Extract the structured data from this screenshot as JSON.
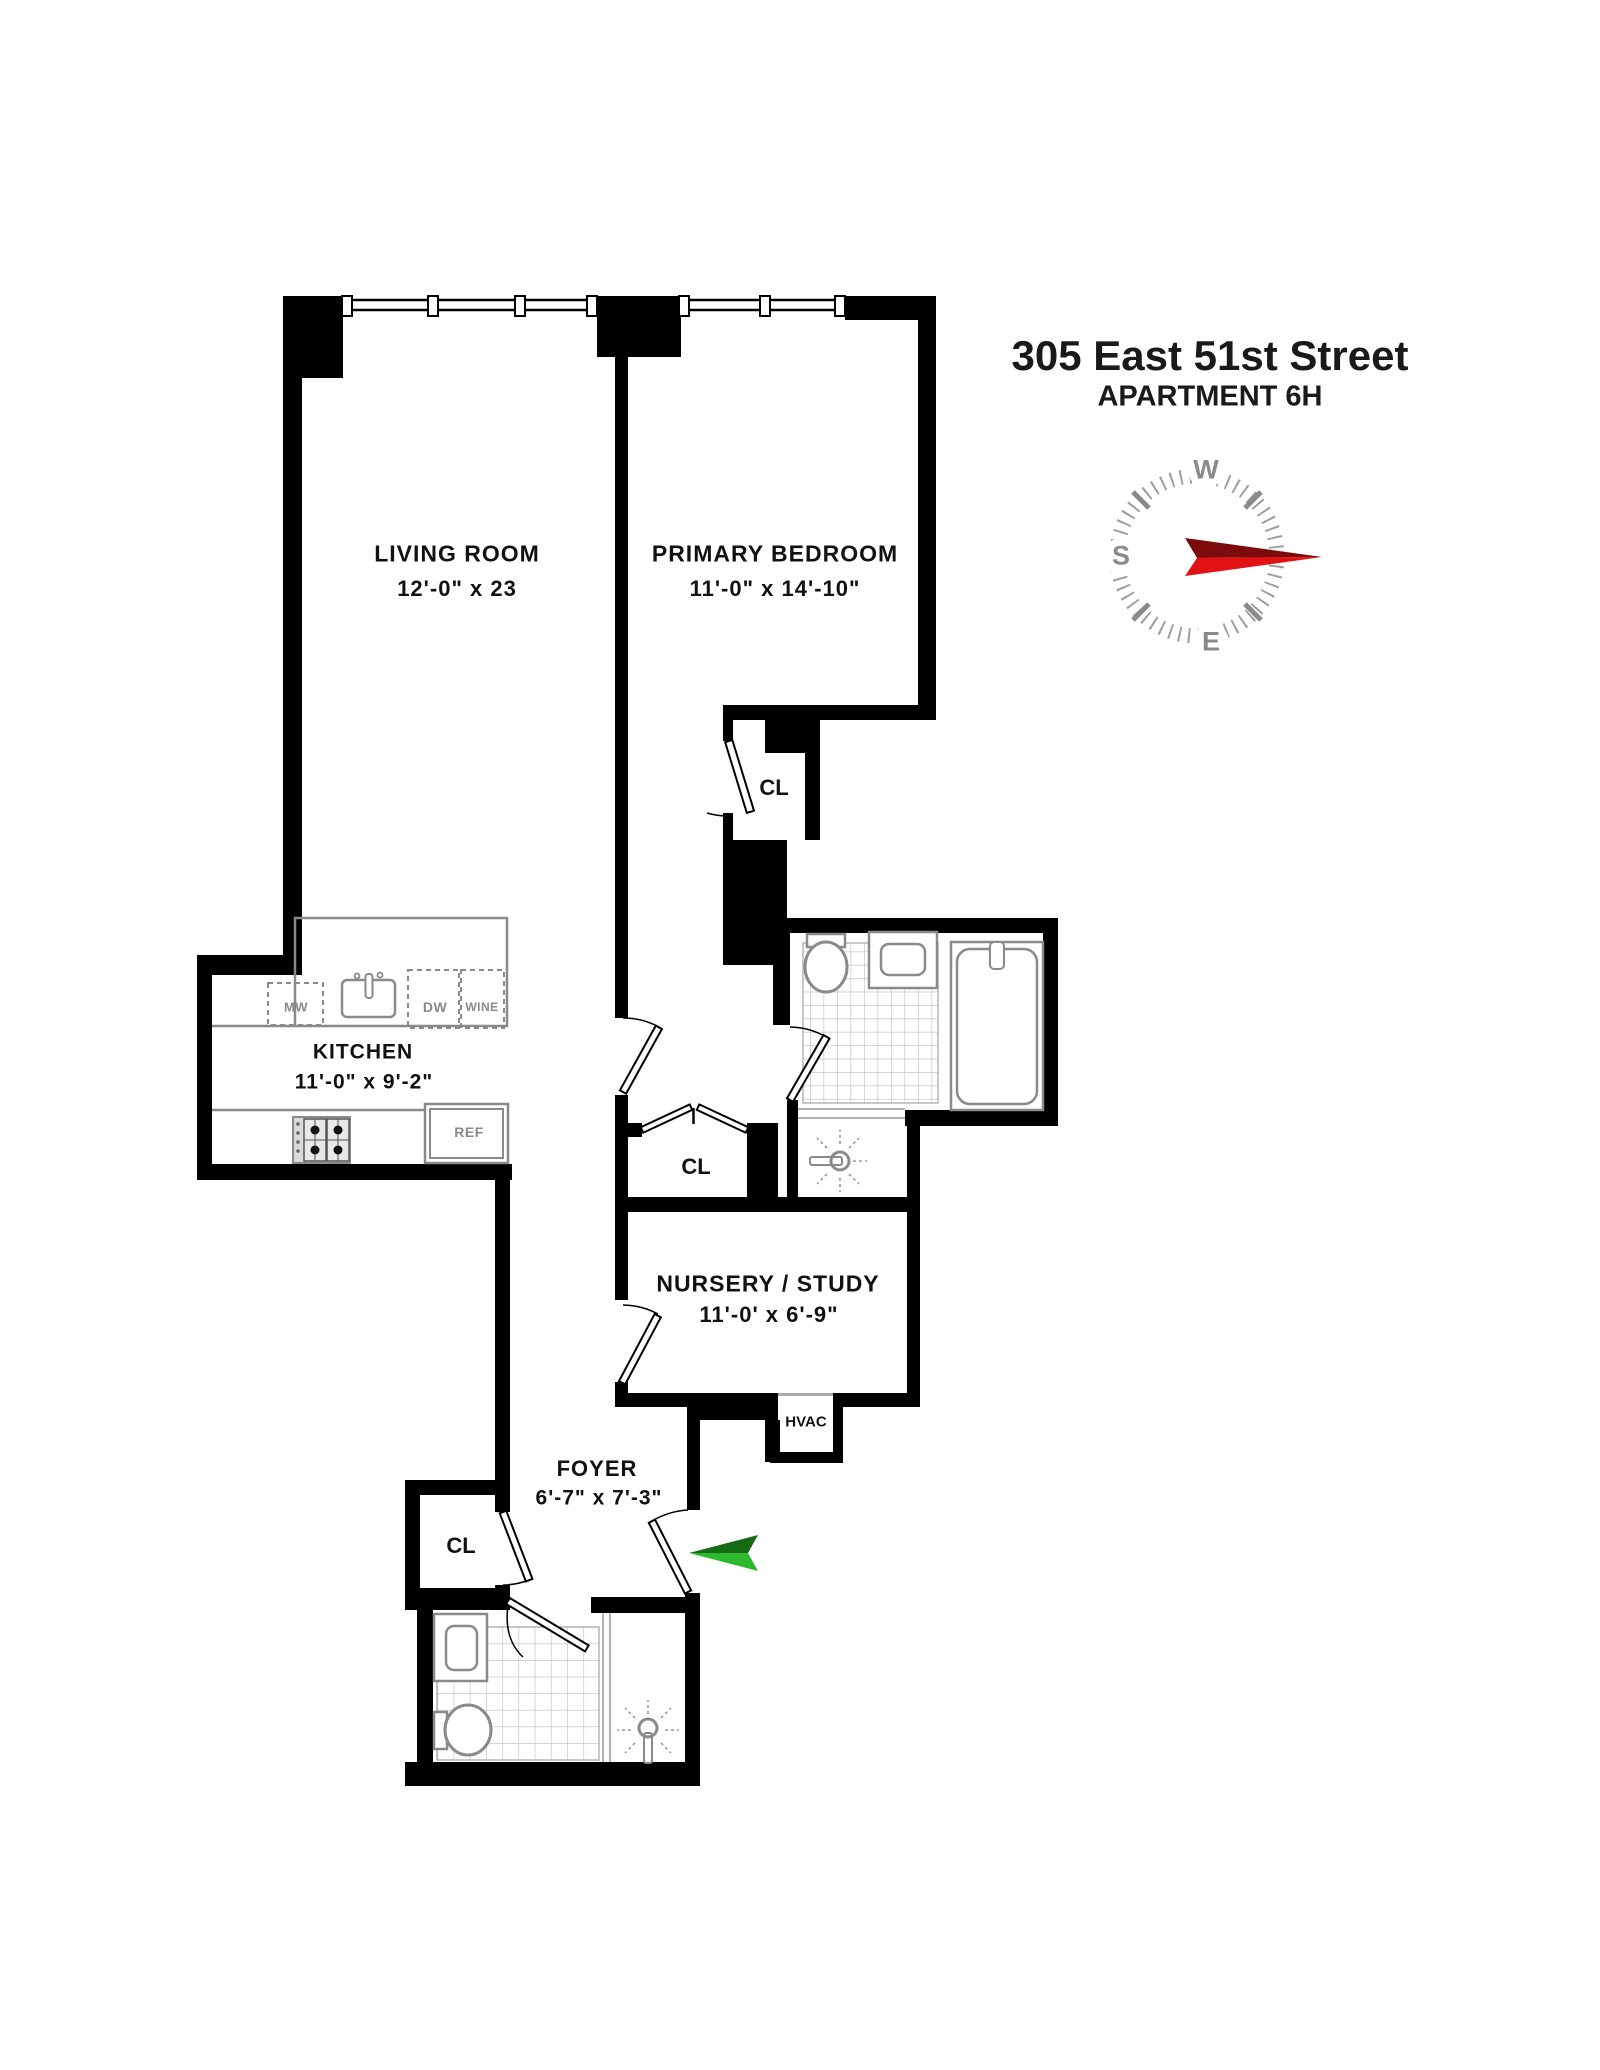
{
  "header": {
    "address": "305 East 51st Street",
    "apartment": "APARTMENT 6H"
  },
  "rooms": {
    "living": {
      "name": "LIVING ROOM",
      "dims": "12'-0\" x 23"
    },
    "bedroom": {
      "name": "PRIMARY BEDROOM",
      "dims": "11'-0\" x 14'-10\""
    },
    "kitchen": {
      "name": "KITCHEN",
      "dims": "11'-0\" x 9'-2\""
    },
    "nursery": {
      "name": "NURSERY / STUDY",
      "dims": "11'-0' x 6'-9\""
    },
    "foyer": {
      "name": "FOYER",
      "dims": "6'-7\" x 7'-3\""
    }
  },
  "closets": {
    "bedroom_closet": "CL",
    "hall_closet": "CL",
    "foyer_closet": "CL"
  },
  "utility": {
    "hvac": "HVAC"
  },
  "appliances": {
    "microwave": "MW",
    "dishwasher": "DW",
    "wine": "WINE",
    "fridge": "REF"
  },
  "compass": {
    "west": "W",
    "south": "S",
    "east": "E",
    "needle_dark": "#7d0b0b",
    "needle_bright": "#e31212",
    "tick_color": "#9e9e9e"
  },
  "entry_arrow": {
    "dark": "#146b14",
    "bright": "#2db82d"
  },
  "icons": [
    "compass-icon",
    "entry-arrow-icon",
    "shower-icon",
    "toilet-icon",
    "sink-icon",
    "bathtub-icon",
    "stove-icon",
    "fridge-icon",
    "kitchen-sink-icon"
  ],
  "colors": {
    "wall": "#000000",
    "fixture": "#8a8a8a",
    "tile": "#c6c6c6"
  }
}
